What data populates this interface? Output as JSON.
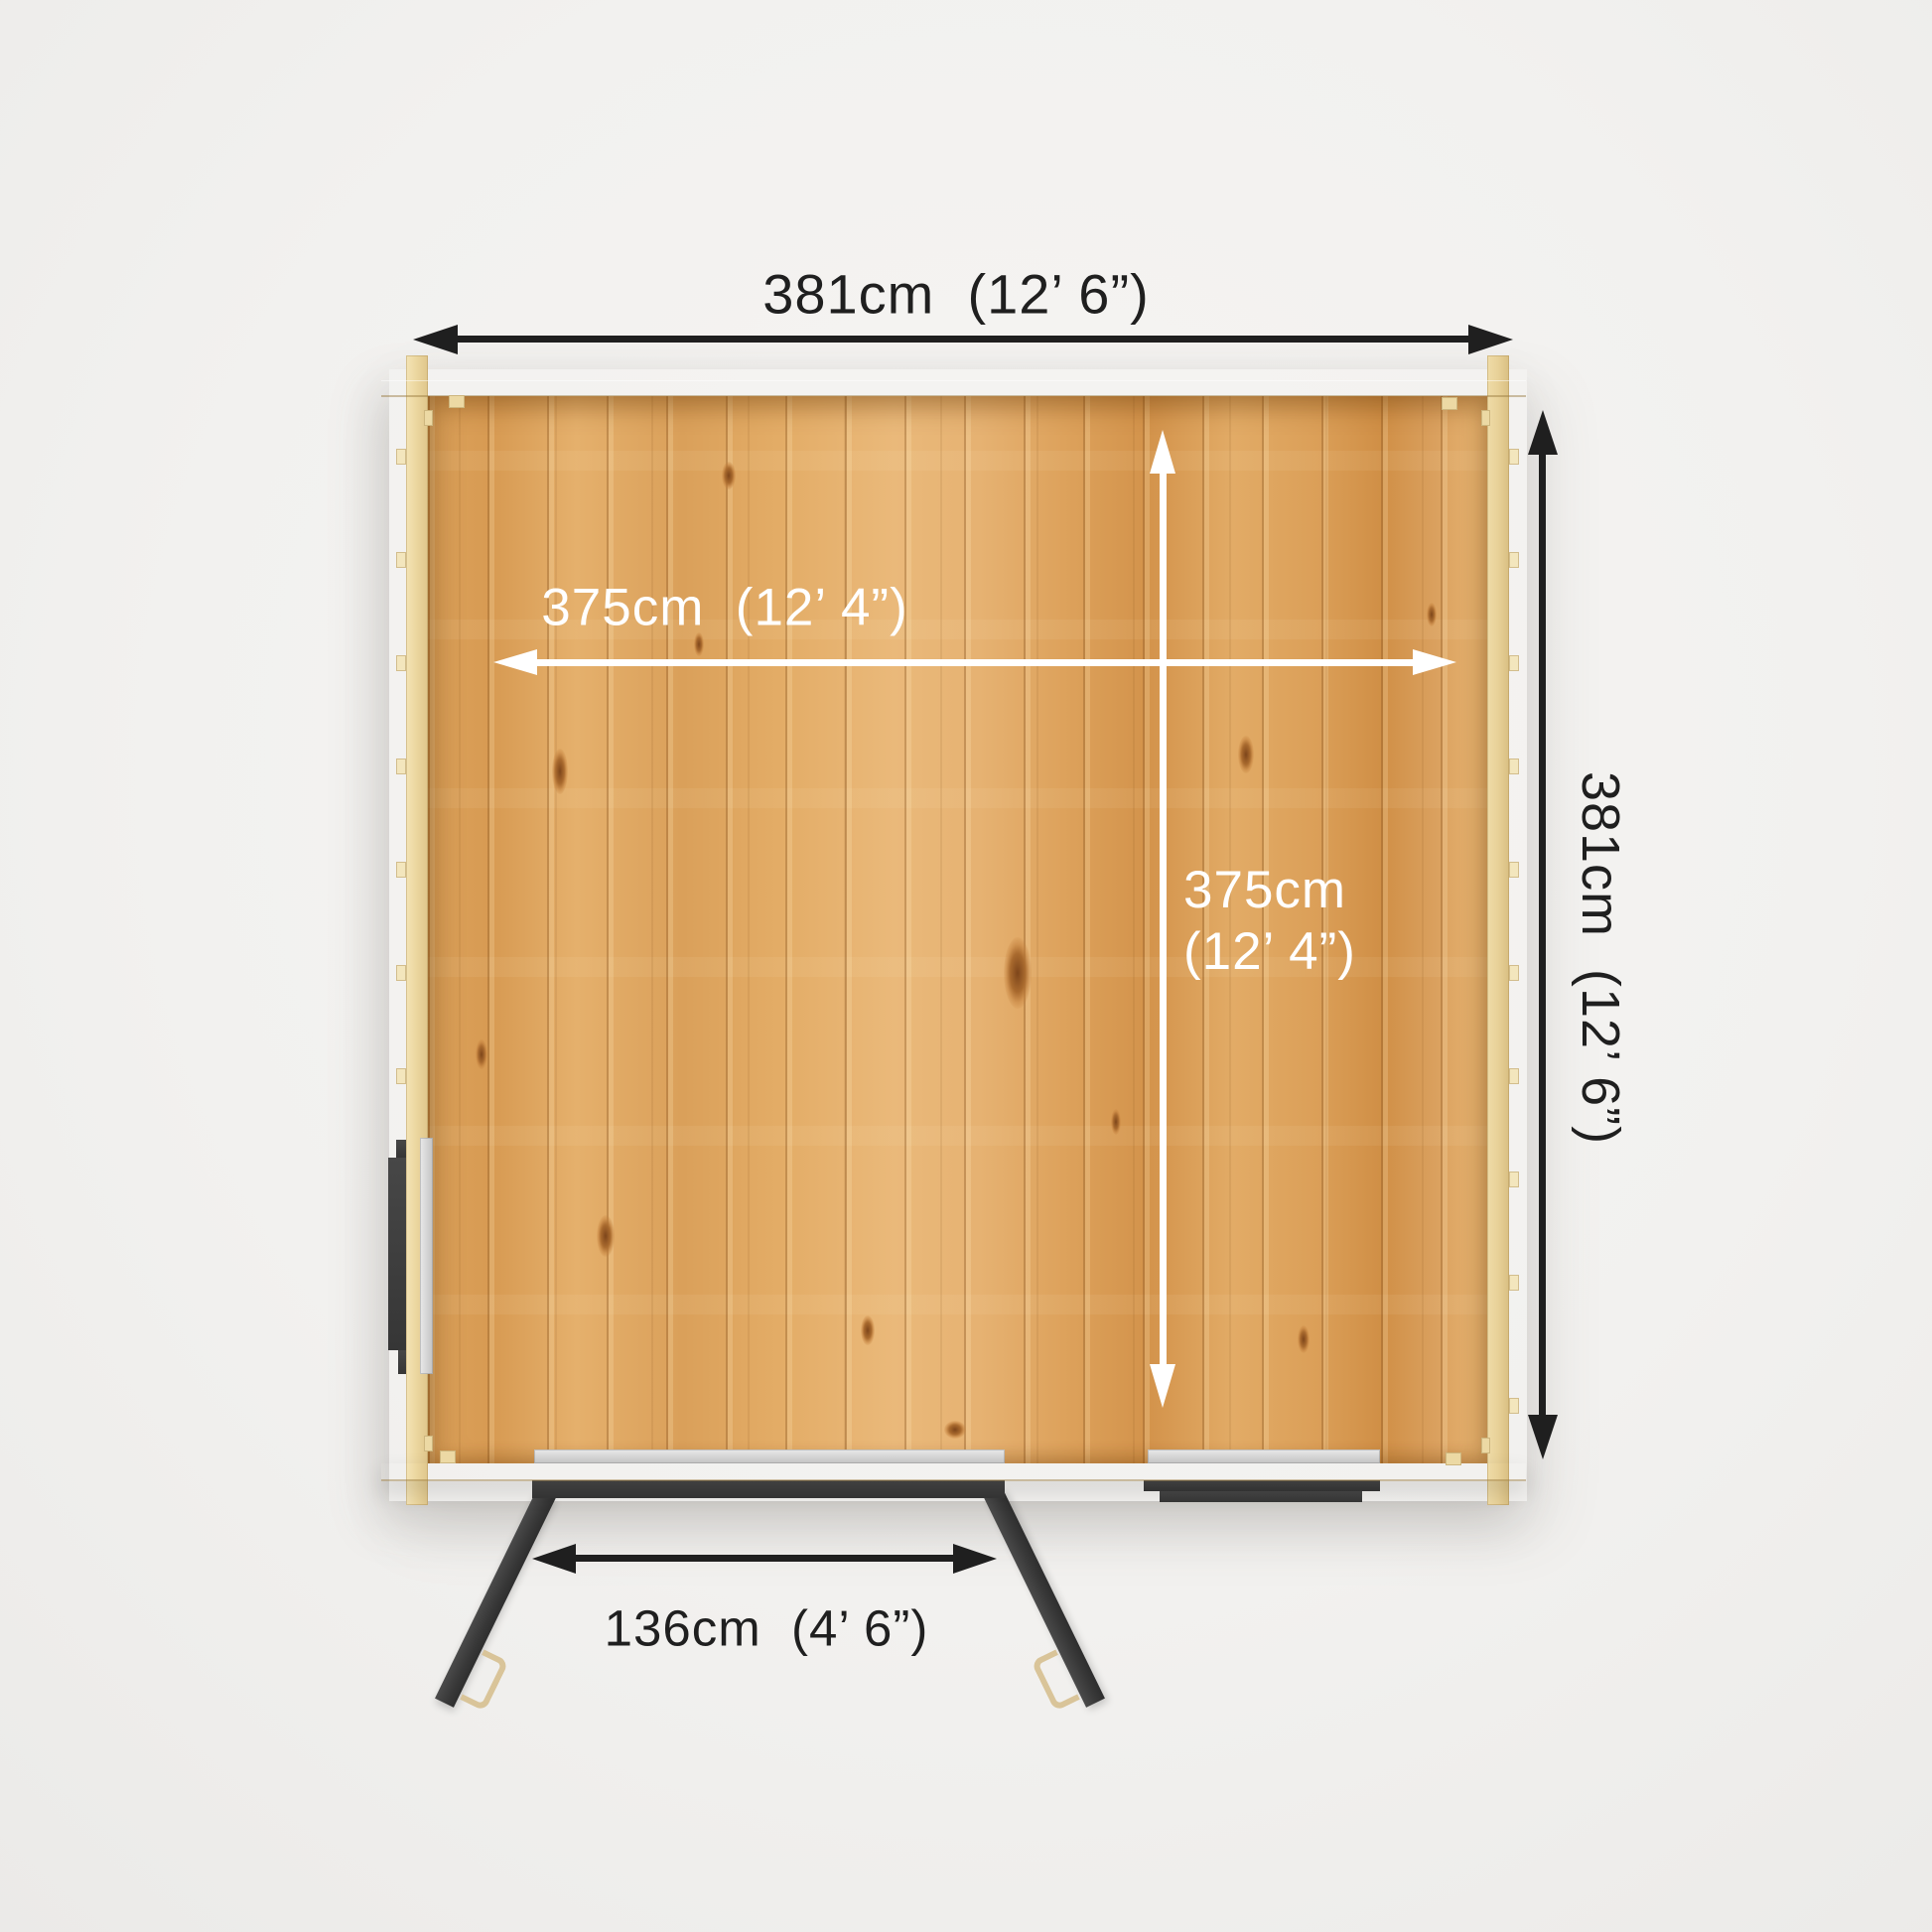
{
  "diagram": {
    "dimensions": {
      "overall_width": {
        "label": "381cm  (12’ 6”)"
      },
      "overall_depth": {
        "label": "381cm  (12’ 6”)"
      },
      "internal_width": {
        "label": "375cm  (12’ 4”)"
      },
      "internal_depth": {
        "line1": "375cm",
        "line2": "(12’ 4”)"
      },
      "door_opening": {
        "label": "136cm  (4’ 6”)"
      }
    }
  },
  "colors": {
    "bg": "#f2f1ef",
    "ink": "#1f1f1f",
    "arrow_white": "#ffffff",
    "wood_floor": "#e0a75f",
    "wood_pale": "#eed9a2",
    "wood_pale_edge": "#c9ab6c",
    "dark_joinery": "#3b3b3b",
    "silver": "#d6d6d6"
  }
}
